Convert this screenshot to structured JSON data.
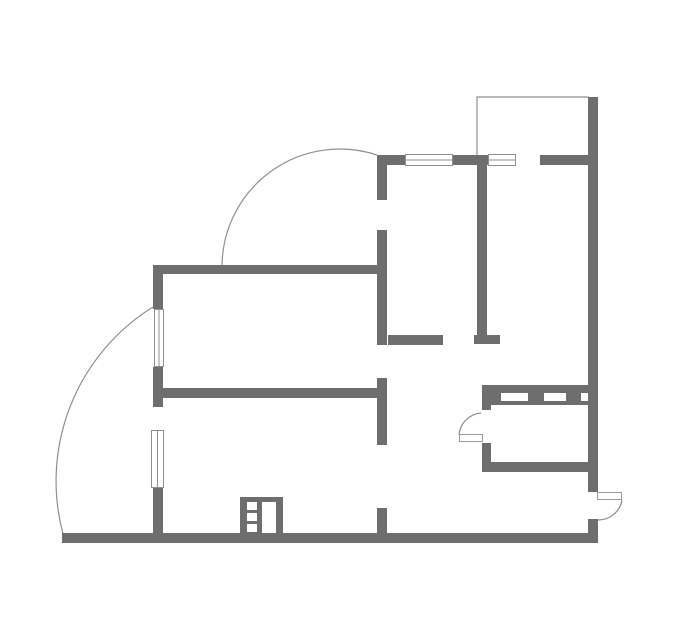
{
  "canvas": {
    "width": 679,
    "height": 634,
    "background": "#ffffff"
  },
  "colors": {
    "wall": "#6e6e6e",
    "thin_line": "#8f8f8f",
    "window_stroke": "#8f8f8f",
    "window_fill": "#ffffff",
    "door_leaf_stroke": "#9a9a9a",
    "door_leaf_fill": "#ffffff",
    "cutout_fill": "#ffffff"
  },
  "plan": {
    "walls": [
      {
        "name": "top-wall-left",
        "x": 377,
        "y": 155,
        "w": 28,
        "h": 10
      },
      {
        "name": "top-wall-mid",
        "x": 453,
        "y": 155,
        "w": 35,
        "h": 10
      },
      {
        "name": "top-wall-right",
        "x": 540,
        "y": 155,
        "w": 48,
        "h": 10
      },
      {
        "name": "right-exterior-wall",
        "x": 588,
        "y": 97,
        "w": 10,
        "h": 395
      },
      {
        "name": "right-wall-below-entry",
        "x": 588,
        "y": 519,
        "w": 10,
        "h": 24
      },
      {
        "name": "bottom-exterior-wall",
        "x": 62,
        "y": 533,
        "w": 536,
        "h": 10
      },
      {
        "name": "left-wall-upper",
        "x": 153,
        "y": 265,
        "w": 10,
        "h": 44
      },
      {
        "name": "left-wall-mid",
        "x": 153,
        "y": 367,
        "w": 10,
        "h": 40
      },
      {
        "name": "left-wall-lower",
        "x": 153,
        "y": 488,
        "w": 10,
        "h": 45
      },
      {
        "name": "upper-room-top-wall",
        "x": 153,
        "y": 265,
        "w": 234,
        "h": 9
      },
      {
        "name": "central-wall-upper",
        "x": 377,
        "y": 165,
        "w": 10,
        "h": 35
      },
      {
        "name": "central-wall-middle",
        "x": 377,
        "y": 230,
        "w": 10,
        "h": 115
      },
      {
        "name": "hall-top-wall",
        "x": 388,
        "y": 335,
        "w": 55,
        "h": 10
      },
      {
        "name": "hall-wall-t-foot",
        "x": 474,
        "y": 335,
        "w": 26,
        "h": 9
      },
      {
        "name": "bedroom-divider-wall",
        "x": 477,
        "y": 165,
        "w": 10,
        "h": 170
      },
      {
        "name": "living-room-south-wall",
        "x": 153,
        "y": 388,
        "w": 224,
        "h": 10
      },
      {
        "name": "central-wall-lower",
        "x": 377,
        "y": 378,
        "w": 10,
        "h": 67
      },
      {
        "name": "central-wall-stub",
        "x": 377,
        "y": 508,
        "w": 10,
        "h": 25
      },
      {
        "name": "kitchen-wall-above-door",
        "x": 482,
        "y": 405,
        "w": 9,
        "h": 5
      },
      {
        "name": "kitchen-wall-below-door",
        "x": 482,
        "y": 443,
        "w": 9,
        "h": 29
      },
      {
        "name": "kitchen-south-wall",
        "x": 482,
        "y": 462,
        "w": 116,
        "h": 10
      }
    ],
    "fixtures": [
      {
        "name": "kitchen-counter-band",
        "outer": {
          "x": 482,
          "y": 385,
          "w": 106,
          "h": 20
        },
        "cutouts": [
          {
            "x": 501,
            "y": 393,
            "w": 27,
            "h": 8
          },
          {
            "x": 544,
            "y": 393,
            "w": 22,
            "h": 8
          },
          {
            "x": 581,
            "y": 393,
            "w": 7,
            "h": 8
          }
        ]
      },
      {
        "name": "entry-cabinet",
        "outer": {
          "x": 240,
          "y": 497,
          "w": 43,
          "h": 37
        },
        "cutouts": [
          {
            "x": 247,
            "y": 502,
            "w": 10,
            "h": 8
          },
          {
            "x": 247,
            "y": 513,
            "w": 10,
            "h": 8
          },
          {
            "x": 247,
            "y": 524,
            "w": 10,
            "h": 8
          },
          {
            "x": 262,
            "y": 502,
            "w": 14,
            "h": 31
          }
        ]
      }
    ],
    "windows": [
      {
        "name": "window-left-upper",
        "x": 154,
        "y": 309,
        "w": 10,
        "h": 58,
        "orient": "v"
      },
      {
        "name": "window-left-lower",
        "x": 151,
        "y": 430,
        "w": 13,
        "h": 58,
        "orient": "v"
      },
      {
        "name": "window-top-left",
        "x": 405,
        "y": 154,
        "w": 48,
        "h": 12,
        "orient": "h"
      },
      {
        "name": "window-top-right",
        "x": 488,
        "y": 154,
        "w": 28,
        "h": 12,
        "orient": "h"
      }
    ],
    "doors": [
      {
        "name": "kitchen-door",
        "leaf": {
          "x": 459,
          "y": 434,
          "w": 24,
          "h": 8
        },
        "swing": "M 481 413 A 24 24 0 0 0 459 435"
      },
      {
        "name": "entry-door",
        "leaf": {
          "x": 597,
          "y": 492,
          "w": 25,
          "h": 8
        },
        "swing": "M 622 500 A 24 24 0 0 1 598 520"
      }
    ],
    "outlines": [
      {
        "name": "balcony-top-right-outline",
        "path": "M 477 155 L 477 97 L 589 97"
      },
      {
        "name": "balcony-upper-curved-outline",
        "path": "M 222 266 A 118 118 0 0 1 377 155"
      },
      {
        "name": "balcony-lower-curved-outline",
        "path": "M 63 534 A 205 205 0 0 1 153 307"
      }
    ]
  }
}
